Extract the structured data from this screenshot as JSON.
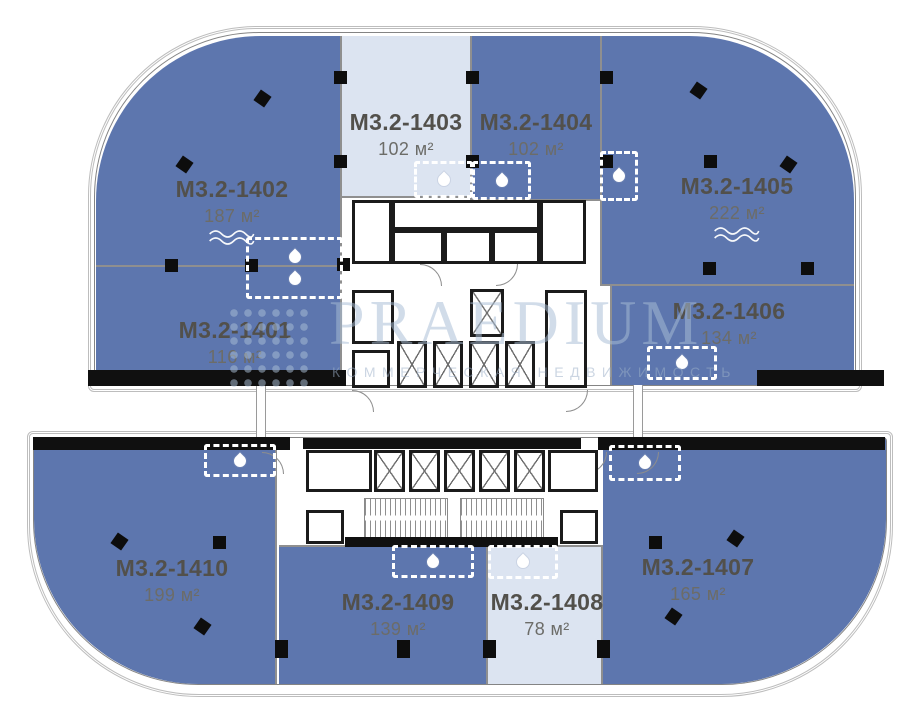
{
  "canvas": {
    "width": 918,
    "height": 704,
    "background": "#ffffff"
  },
  "colors": {
    "unit_dark": "#5d76ae",
    "unit_light": "#dce4f1",
    "unit_boundary": "#8f8f8f",
    "wall_black": "#101010",
    "label_text": "#52504b",
    "area_text": "#6c6c68",
    "watermark_blue": "#a9bed6",
    "watermark_sub": "#9cb0c8"
  },
  "watermark": {
    "brand": "PRAEDIUM",
    "subtitle": "КОММЕРЧЕСКАЯ НЕДВИЖИМОСТЬ",
    "logo_icon": "dot-matrix-square"
  },
  "units": [
    {
      "id": "M3.2-1401",
      "area": "116 м²",
      "fill": "dark",
      "wave": false,
      "rect": [
        96,
        267,
        246,
        119
      ],
      "radius": "",
      "borders": [
        "r"
      ],
      "label": [
        235,
        317
      ]
    },
    {
      "id": "M3.2-1402",
      "area": "187 м²",
      "fill": "dark",
      "wave": true,
      "rect": [
        96,
        36,
        246,
        231
      ],
      "radius": "165px 0 0 0",
      "borders": [
        "r",
        "b"
      ],
      "label": [
        232,
        176
      ]
    },
    {
      "id": "M3.2-1403",
      "area": "102 м²",
      "fill": "light",
      "wave": false,
      "rect": [
        342,
        36,
        128,
        162
      ],
      "radius": "",
      "borders": [
        "b"
      ],
      "label": [
        406,
        109
      ]
    },
    {
      "id": "M3.2-1404",
      "area": "102 м²",
      "fill": "dark",
      "wave": false,
      "rect": [
        470,
        36,
        130,
        165
      ],
      "radius": "",
      "borders": [
        "l",
        "b"
      ],
      "label": [
        536,
        109
      ]
    },
    {
      "id": "M3.2-1405",
      "area": "222 м²",
      "fill": "dark",
      "wave": true,
      "rect": [
        600,
        36,
        254,
        250
      ],
      "radius": "0 165px 0 0",
      "borders": [
        "l",
        "b"
      ],
      "label": [
        737,
        173
      ]
    },
    {
      "id": "M3.2-1406",
      "area": "134 м²",
      "fill": "dark",
      "wave": false,
      "rect": [
        610,
        286,
        244,
        100
      ],
      "radius": "",
      "borders": [
        "l"
      ],
      "label": [
        729,
        298
      ]
    },
    {
      "id": "M3.2-1407",
      "area": "165 м²",
      "fill": "dark",
      "wave": false,
      "rect": [
        603,
        438,
        283,
        246
      ],
      "radius": "0 0 165px 0",
      "borders": [],
      "label": [
        698,
        554
      ]
    },
    {
      "id": "M3.2-1408",
      "area": "78 м²",
      "fill": "light",
      "wave": false,
      "rect": [
        488,
        545,
        115,
        139
      ],
      "radius": "",
      "borders": [
        "r",
        "t"
      ],
      "label": [
        547,
        589
      ]
    },
    {
      "id": "M3.2-1409",
      "area": "139 м²",
      "fill": "dark",
      "wave": false,
      "rect": [
        279,
        545,
        209,
        139
      ],
      "radius": "",
      "borders": [
        "r",
        "t"
      ],
      "label": [
        398,
        589
      ]
    },
    {
      "id": "M3.2-1410",
      "area": "199 м²",
      "fill": "dark",
      "wave": false,
      "rect": [
        34,
        438,
        243,
        246
      ],
      "radius": "0 0 0 165px",
      "borders": [
        "r"
      ],
      "label": [
        172,
        555
      ]
    }
  ],
  "plan": {
    "outlines": [
      {
        "rect": [
          88,
          26,
          774,
          366
        ],
        "radius": "170px 170px 6px 6px",
        "kind": "glaze"
      },
      {
        "rect": [
          94,
          32,
          762,
          354
        ],
        "radius": "165px 165px 3px 3px",
        "kind": "wallline"
      },
      {
        "rect": [
          27,
          431,
          866,
          266
        ],
        "radius": "6px 6px 172px 172px",
        "kind": "glaze"
      },
      {
        "rect": [
          33,
          437,
          854,
          248
        ],
        "radius": "4px 4px 165px 165px",
        "kind": "wallline"
      }
    ],
    "bars": [
      [
        88,
        370,
        258,
        16
      ],
      [
        757,
        370,
        127,
        16
      ],
      [
        33,
        437,
        257,
        13
      ],
      [
        598,
        437,
        287,
        13
      ],
      [
        303,
        438,
        278,
        11
      ],
      [
        345,
        537,
        213,
        10
      ]
    ],
    "rooms": [
      [
        352,
        200,
        40,
        64
      ],
      [
        392,
        200,
        148,
        30
      ],
      [
        392,
        230,
        52,
        34
      ],
      [
        444,
        230,
        48,
        34
      ],
      [
        492,
        230,
        48,
        34
      ],
      [
        540,
        200,
        46,
        64
      ],
      [
        352,
        290,
        42,
        54
      ],
      [
        545,
        290,
        42,
        98
      ],
      [
        352,
        350,
        38,
        38
      ],
      [
        306,
        450,
        66,
        42
      ],
      [
        548,
        450,
        50,
        42
      ],
      [
        306,
        510,
        38,
        34
      ],
      [
        560,
        510,
        38,
        34
      ]
    ],
    "shafts": [
      [
        470,
        289,
        34,
        48
      ],
      [
        397,
        341,
        30,
        47
      ],
      [
        433,
        341,
        30,
        47
      ],
      [
        469,
        341,
        30,
        47
      ],
      [
        505,
        341,
        30,
        47
      ],
      [
        374,
        450,
        31,
        42
      ],
      [
        409,
        450,
        31,
        42
      ],
      [
        444,
        450,
        31,
        42
      ],
      [
        479,
        450,
        31,
        42
      ],
      [
        514,
        450,
        31,
        42
      ]
    ],
    "stairs": [
      [
        364,
        498,
        84,
        40
      ],
      [
        460,
        498,
        84,
        40
      ]
    ],
    "connectors": [
      [
        256,
        385,
        10,
        54
      ],
      [
        633,
        385,
        10,
        54
      ]
    ],
    "arcs": [
      [
        352,
        390,
        0
      ],
      [
        566,
        390,
        90
      ],
      [
        340,
        452,
        0
      ],
      [
        585,
        452,
        90
      ],
      [
        420,
        264,
        0
      ],
      [
        496,
        264,
        90
      ],
      [
        637,
        452,
        90
      ],
      [
        262,
        452,
        0
      ]
    ],
    "columns": [
      [
        256,
        92,
        35,
        13
      ],
      [
        178,
        158,
        35,
        13
      ],
      [
        334,
        71,
        0,
        13
      ],
      [
        466,
        71,
        0,
        13
      ],
      [
        600,
        71,
        0,
        13
      ],
      [
        334,
        155,
        0,
        13
      ],
      [
        466,
        155,
        0,
        13
      ],
      [
        600,
        155,
        0,
        13
      ],
      [
        692,
        84,
        35,
        13
      ],
      [
        704,
        155,
        0,
        13
      ],
      [
        782,
        158,
        35,
        13
      ],
      [
        165,
        259,
        0,
        13
      ],
      [
        245,
        259,
        0,
        13
      ],
      [
        337,
        258,
        0,
        13
      ],
      [
        703,
        262,
        0,
        13
      ],
      [
        801,
        262,
        0,
        13
      ],
      [
        113,
        535,
        35,
        13
      ],
      [
        213,
        536,
        0,
        13
      ],
      [
        196,
        620,
        35,
        13
      ],
      [
        649,
        536,
        0,
        13
      ],
      [
        729,
        532,
        35,
        13
      ],
      [
        667,
        610,
        35,
        13
      ],
      [
        275,
        640,
        0,
        18
      ],
      [
        397,
        640,
        0,
        18
      ],
      [
        483,
        640,
        0,
        18
      ],
      [
        597,
        640,
        0,
        18
      ]
    ],
    "wet_points": [
      [
        246,
        237,
        97,
        62,
        2
      ],
      [
        414,
        161,
        59,
        37,
        1
      ],
      [
        472,
        161,
        59,
        39,
        1
      ],
      [
        600,
        151,
        38,
        50,
        1
      ],
      [
        647,
        346,
        70,
        34,
        1
      ],
      [
        204,
        444,
        72,
        33,
        1
      ],
      [
        609,
        445,
        72,
        36,
        1
      ],
      [
        392,
        545,
        82,
        33,
        1
      ],
      [
        488,
        545,
        70,
        34,
        1
      ]
    ]
  }
}
